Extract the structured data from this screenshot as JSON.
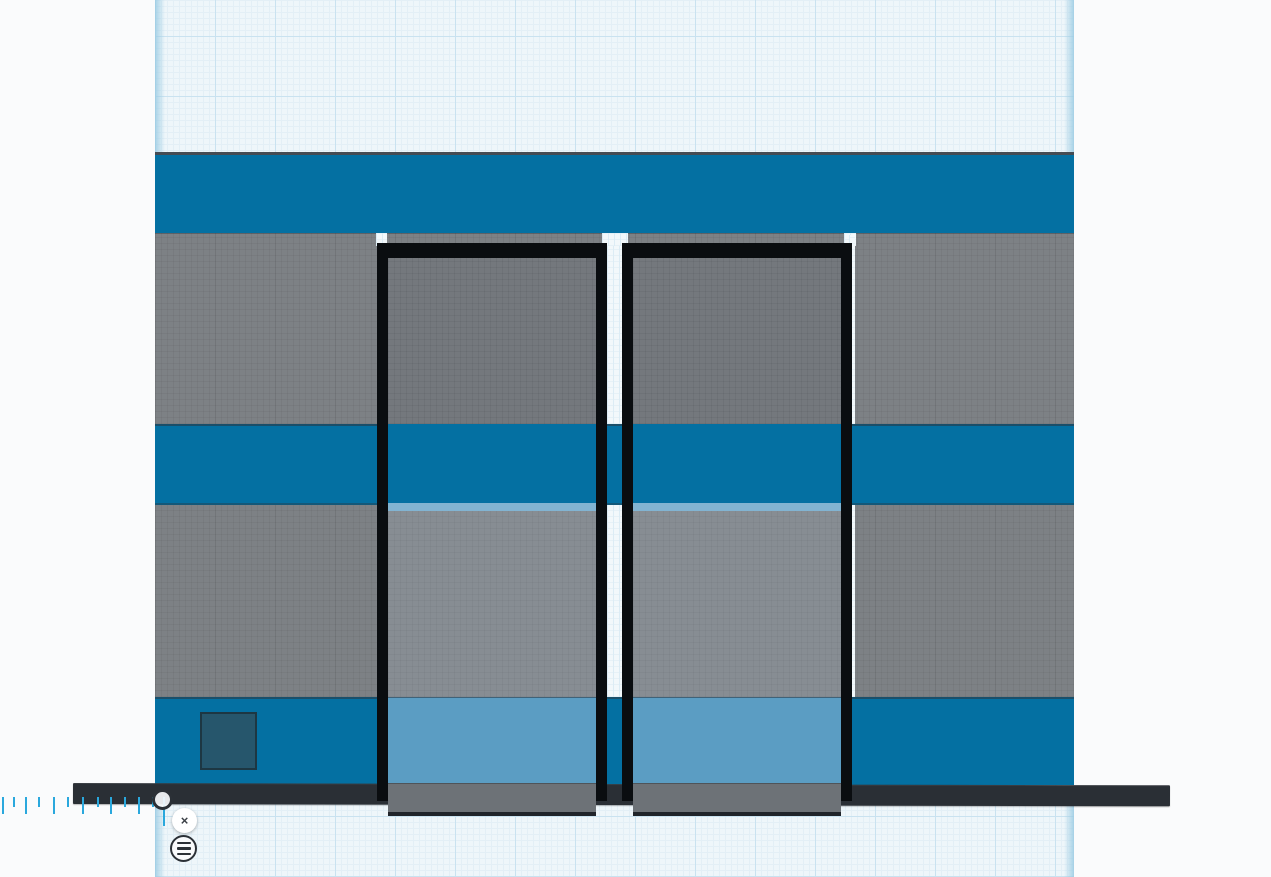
{
  "colors": {
    "page-bg": "#fafbfc",
    "grid-bg": "#eef6fa",
    "grid-minor": "#e3eff6",
    "grid-major": "#c9e2f0",
    "wall-blue": "#0470a2",
    "wall-gray": "#7d8185",
    "frame-black": "#0a0d10",
    "glass-gray-dark": "#74787d",
    "glass-gray-light": "#878d93",
    "glass-blue": "#5b9dc3",
    "glass-top-strip": "#82b4d2",
    "glass-bar-tint": "#6d7277",
    "panel-teal": "#26566c",
    "bar-dark": "#2a2f35",
    "tick-blue": "#2aa8dd",
    "icon-dark": "#2b3036",
    "button-bg": "#ffffff"
  },
  "ruler": {
    "close_glyph": "×",
    "close_icon": "close-icon",
    "menu_icon": "hamburger-menu-icon",
    "handle_icon": "origin-circle-handle",
    "baseline_y": 797,
    "ticks": [
      {
        "x": 163,
        "len": 29
      },
      {
        "x": 151.5,
        "len": 10
      },
      {
        "x": 138,
        "len": 17
      },
      {
        "x": 123.5,
        "len": 10
      },
      {
        "x": 110,
        "len": 17
      },
      {
        "x": 96.5,
        "len": 10
      },
      {
        "x": 81.5,
        "len": 17
      },
      {
        "x": 66.5,
        "len": 10
      },
      {
        "x": 53,
        "len": 17
      },
      {
        "x": 38,
        "len": 10
      },
      {
        "x": 25,
        "len": 17
      },
      {
        "x": 13,
        "len": 10
      },
      {
        "x": 1.5,
        "len": 17
      }
    ]
  }
}
